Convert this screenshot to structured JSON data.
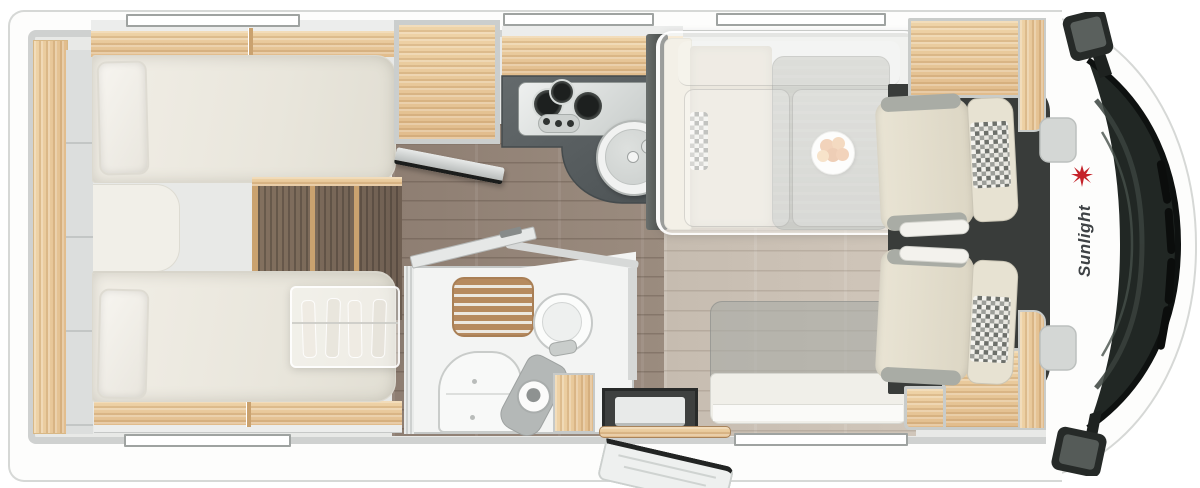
{
  "brand": {
    "name": "Sunlight",
    "logo_icon": "sun-icon",
    "accent_color": "#c5232a",
    "text_color": "#3e4245"
  },
  "palette": {
    "body_white": "#fdfdfc",
    "wall_gray": "#cfd1d0",
    "interior_gray": "#e8e9e7",
    "wood_light": "#e9cd9f",
    "wood_dark": "#7b695a",
    "floor_aisle": "#95867b",
    "floor_dinette": "#cbc1b5",
    "counter_anthracite": "#565c5e",
    "upholstery_cream": "#e9e4d4",
    "cab_floor": "#393c3a",
    "windshield_glass": "#212724",
    "table_gray": "#abada6"
  }
}
